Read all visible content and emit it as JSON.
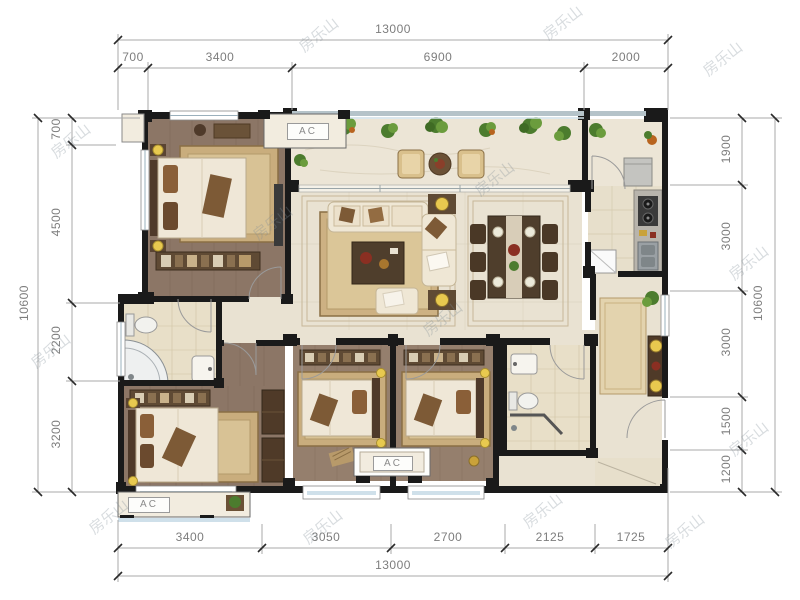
{
  "document": {
    "type": "apartment-floor-plan"
  },
  "labels": {
    "ac": "AC"
  },
  "watermark": {
    "text": "房乐山"
  },
  "dimensions": {
    "top": {
      "total": "13000",
      "segments": [
        "700",
        "3400",
        "6900",
        "2000"
      ]
    },
    "bottom": {
      "total": "13000",
      "segments": [
        "3400",
        "3050",
        "2700",
        "2125",
        "1725"
      ]
    },
    "left": {
      "total": "10600",
      "segments": [
        "700",
        "4500",
        "2200",
        "3200"
      ]
    },
    "right": {
      "total": "10600",
      "segments": [
        "1900",
        "3000",
        "3000",
        "1500",
        "1200"
      ]
    }
  },
  "colors": {
    "wall": "#1a1a1a",
    "wood_floor": "#8c7666",
    "wood_floor_light": "#957f6d",
    "marble_floor": "#e9e2d2",
    "tile_floor": "#e8dfc8",
    "rug": "#c9ad7d",
    "rug_border": "#8a6f45",
    "furniture_dark": "#4f3a28",
    "bed": "#efe7d7",
    "lamp_yellow": "#e8c94f",
    "plant_green": "#4c7c2e",
    "window_glass": "#cfe0ea",
    "dimension_text": "#7d7d7d",
    "accent_red": "#8a2f22"
  }
}
